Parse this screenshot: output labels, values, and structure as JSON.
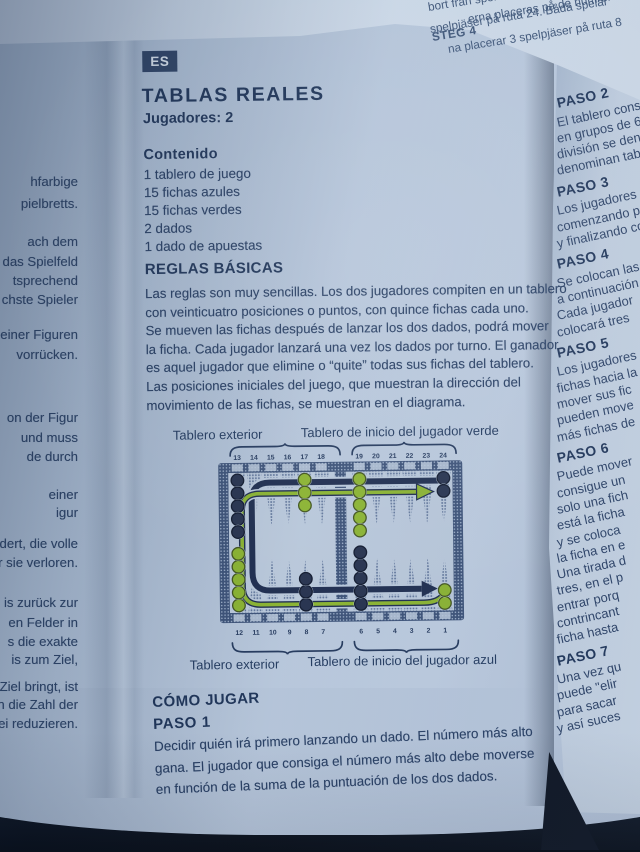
{
  "colors": {
    "paper": "#b8c7da",
    "ink": "#24395d",
    "navy_arrow": "#1e2d4f",
    "green": "#8ab331",
    "background_dark": "#0a111d",
    "badge_bg": "#2e4366"
  },
  "page": {
    "language_badge": "ES",
    "title": "TABLAS REALES",
    "players_line": "Jugadores: 2",
    "contents": {
      "heading": "Contenido",
      "items": [
        "1 tablero de juego",
        "15 fichas azules",
        "15 fichas verdes",
        "2 dados",
        "1 dado de apuestas"
      ]
    },
    "basic_rules": {
      "heading": "REGLAS BÁSICAS",
      "lines": [
        "Las reglas son muy sencillas. Los dos jugadores compiten en un tablero",
        "con veinticuatro posiciones o puntos, con quince fichas cada uno.",
        "Se mueven las fichas después de lanzar los dos dados, podrá mover",
        "la ficha. Cada jugador lanzará una vez los dados por turno. El ganador",
        "es aquel jugador que elimine o “quite” todas sus fichas del tablero.",
        "Las posiciones iniciales del juego, que muestran la dirección del",
        "movimiento de las fichas, se muestran en el diagrama."
      ]
    },
    "diagram": {
      "labels": {
        "top_left": "Tablero exterior",
        "top_right": "Tablero de inicio del jugador verde",
        "bottom_left": "Tablero exterior",
        "bottom_right": "Tablero de inicio del jugador azul"
      },
      "top_numbers": [
        "13",
        "14",
        "15",
        "16",
        "17",
        "18",
        "19",
        "20",
        "21",
        "22",
        "23",
        "24"
      ],
      "bottom_numbers": [
        "12",
        "11",
        "10",
        "9",
        "8",
        "7",
        "6",
        "5",
        "4",
        "3",
        "2",
        "1"
      ],
      "checkers": [
        {
          "side": "top",
          "col": 0,
          "count": 5,
          "color": "blue"
        },
        {
          "side": "top",
          "col": 4,
          "count": 3,
          "color": "green"
        },
        {
          "side": "top",
          "col": 6,
          "count": 5,
          "color": "green"
        },
        {
          "side": "top",
          "col": 11,
          "count": 2,
          "color": "blue"
        },
        {
          "side": "bottom",
          "col": 0,
          "count": 5,
          "color": "green"
        },
        {
          "side": "bottom",
          "col": 4,
          "count": 3,
          "color": "blue"
        },
        {
          "side": "bottom",
          "col": 6,
          "count": 5,
          "color": "blue"
        },
        {
          "side": "bottom",
          "col": 11,
          "count": 2,
          "color": "green"
        }
      ]
    },
    "how_to_play": {
      "heading": "CÓMO JUGAR",
      "step_heading": "PASO 1",
      "lines": [
        "Decidir quién irá primero lanzando un dado. El número más alto",
        "gana. El jugador que consiga el número más alto debe moverse",
        "en función de la suma de la puntuación de los dos dados."
      ]
    }
  },
  "adjacent_left_page_fragments": [
    "hfarbige",
    "pielbretts.",
    "ach dem",
    "das Spielfeld",
    "tsprechend",
    "chste Spieler",
    "einer Figuren",
    "vorrücken.",
    "on der Figur",
    "und muss",
    "de durch",
    "einer",
    "igur",
    "ndert, die volle",
    "r sie verloren.",
    "is zurück zur",
    "en Felder in",
    "s die exakte",
    "is zum Ziel,",
    "ns Ziel bringt, ist",
    "an die Zahl der",
    "drei reduzieren."
  ],
  "adjacent_right_page": {
    "steps": [
      {
        "heading": "PASO 2",
        "lines": [
          "El tablero const",
          "en grupos de 6.",
          "división se deno",
          "denominan tabl"
        ]
      },
      {
        "heading": "PASO 3",
        "lines": [
          "Los jugadores c",
          "comenzando pu",
          "y finalizando co"
        ]
      },
      {
        "heading": "PASO 4",
        "lines": [
          "Se colocan las",
          "a continuación",
          "Cada jugador",
          "colocará tres"
        ]
      },
      {
        "heading": "PASO 5",
        "lines": [
          "Los jugadores",
          "fichas hacia la",
          "mover sus fic",
          "pueden move",
          "más fichas de"
        ]
      },
      {
        "heading": "PASO 6",
        "lines": [
          "Puede mover",
          "consigue un",
          "solo una fich",
          "está la ficha",
          "y se coloca",
          "la ficha en e",
          "Una tirada d",
          "tres, en el p",
          "entrar porq",
          "contrincant",
          "ficha hasta"
        ]
      },
      {
        "heading": "PASO 7",
        "lines": [
          "Una vez qu",
          "puede \"elir",
          "para sacar",
          "y así suces"
        ]
      }
    ]
  },
  "top_page_fragments": [
    "bort från spel",
    "STEG 4",
    "erna placeras på de numrerad",
    "spelpjäser på ruta 24. Båda spelar",
    "na placerar 3 spelpjäser på ruta 8"
  ]
}
